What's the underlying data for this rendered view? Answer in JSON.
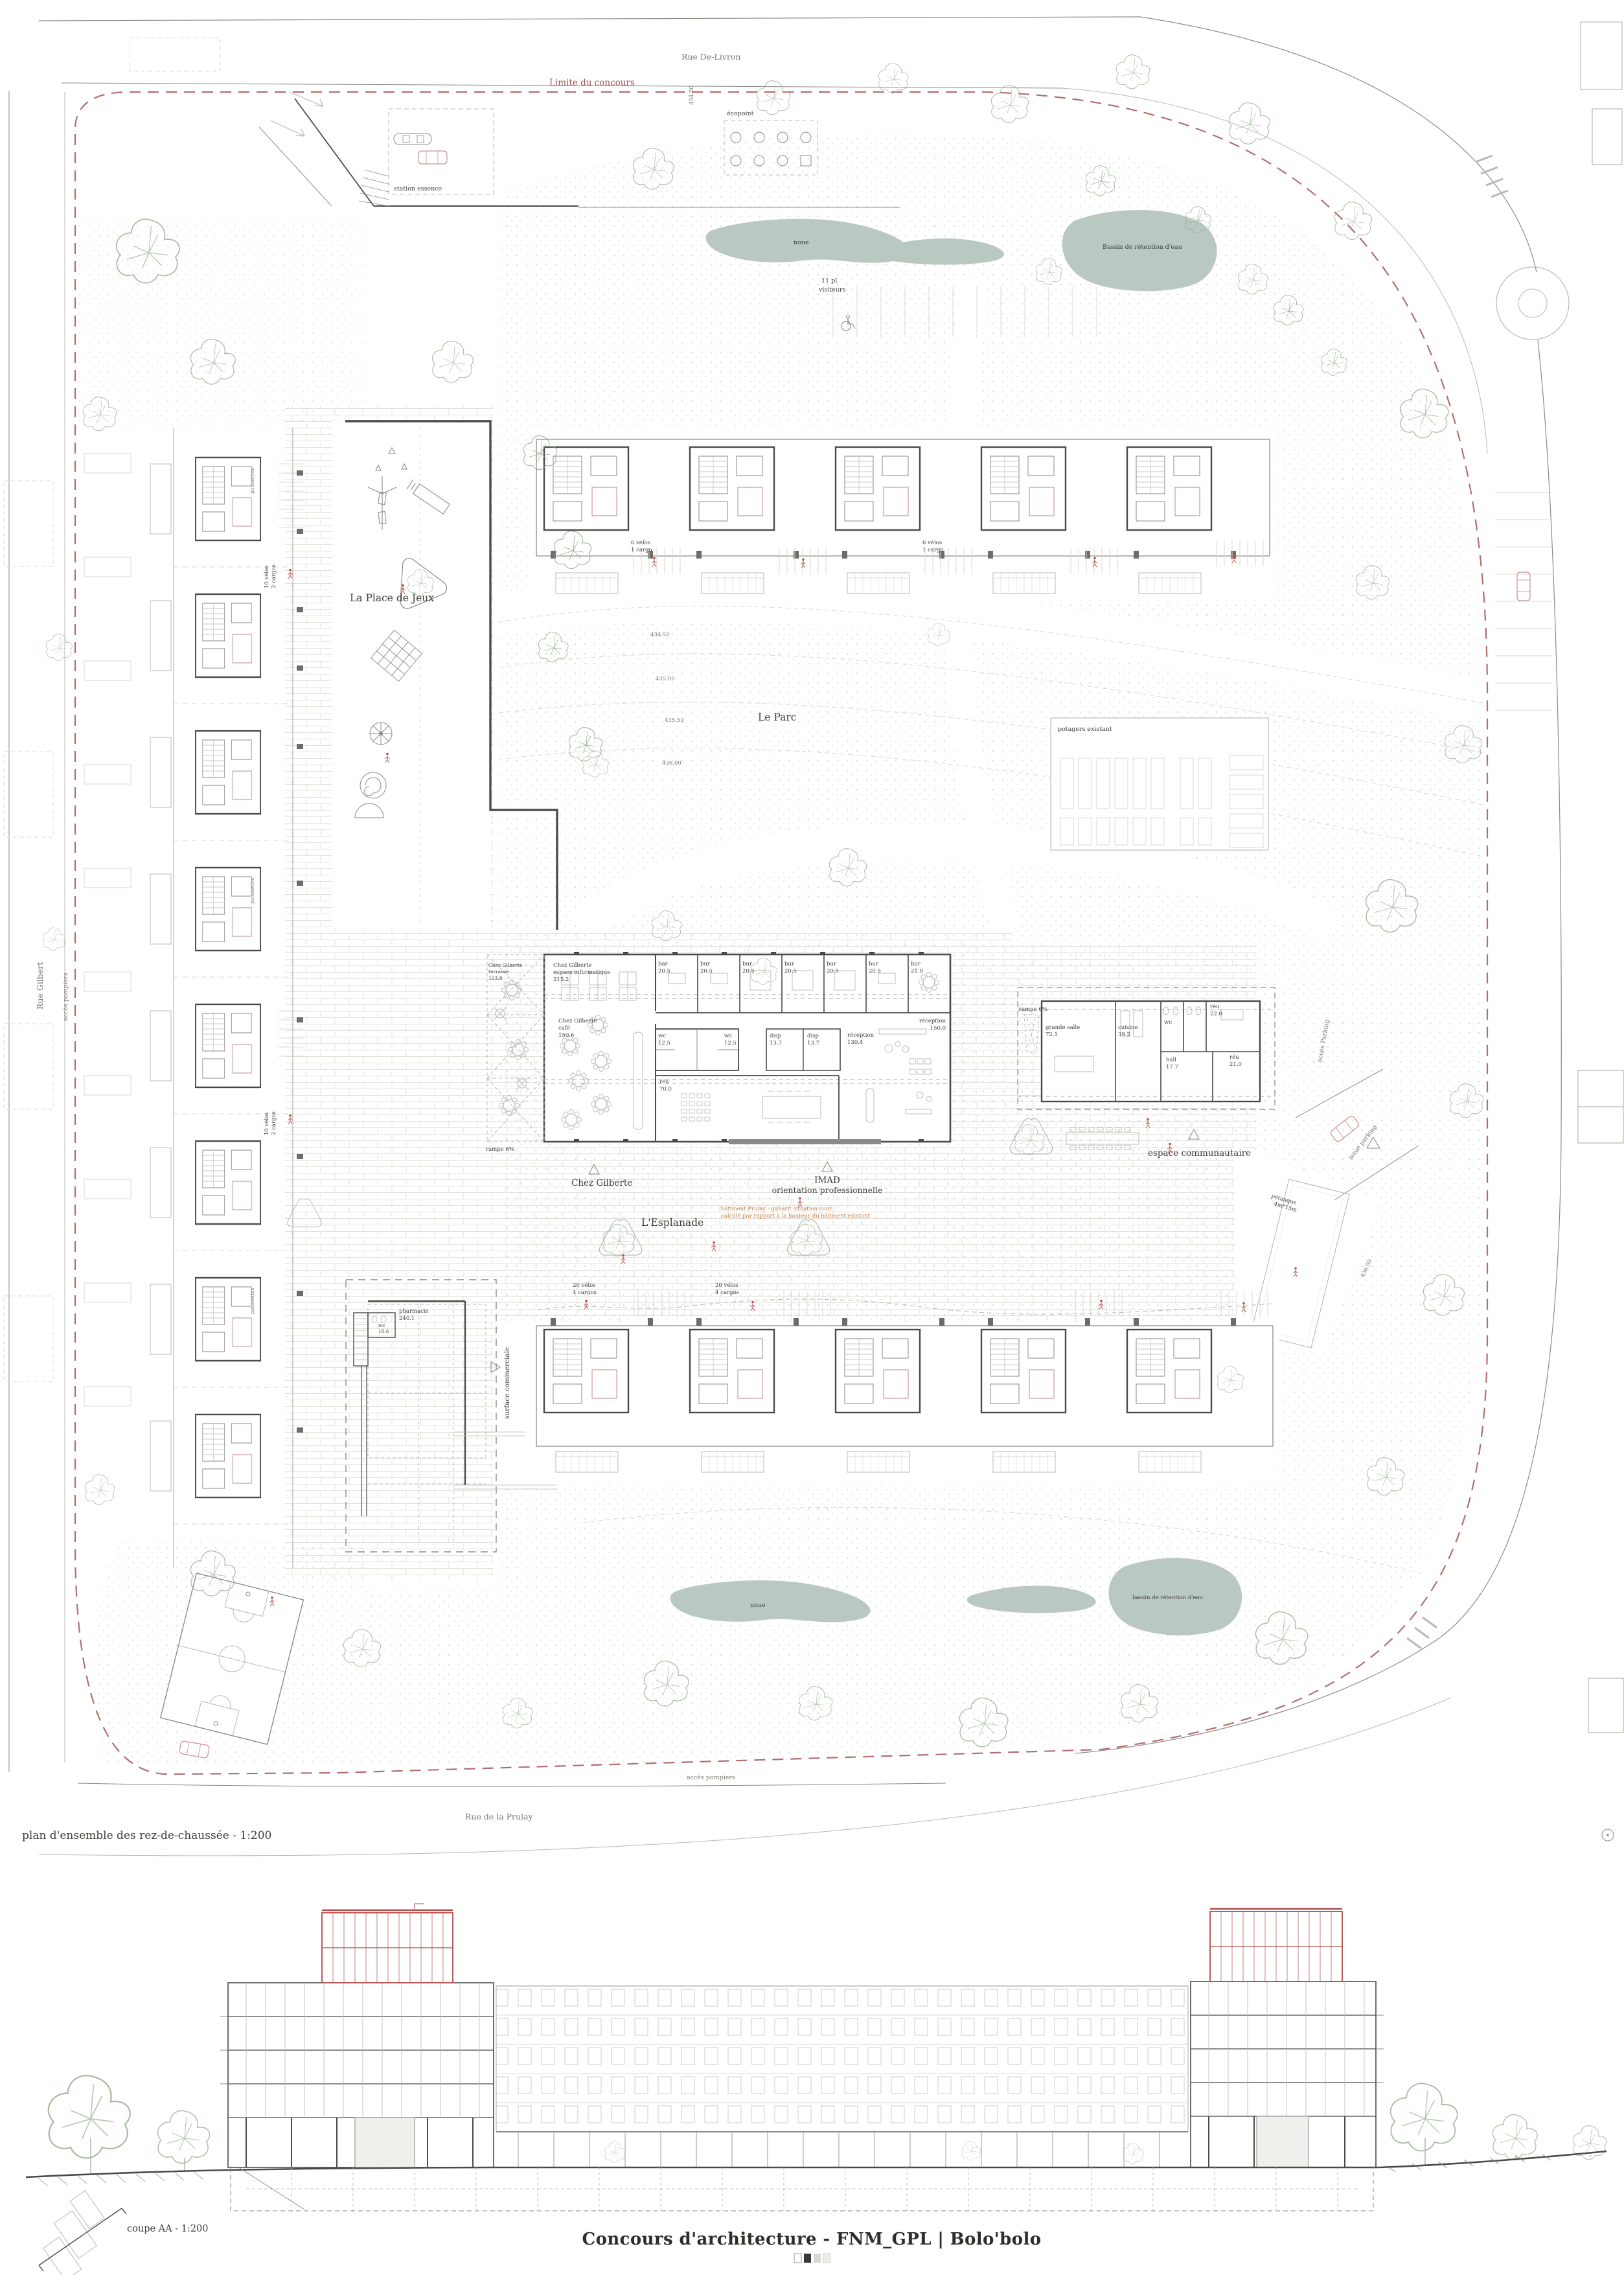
{
  "sheet": {
    "title": "Concours d'architecture - FNM_GPL | Bolo'bolo",
    "plan_caption": "plan d'ensemble des rez-de-chaussée - 1:200",
    "section_caption": "coupe AA - 1:200"
  },
  "streets": {
    "top": "Rue De-Livron",
    "left": "Rue Gilbert",
    "bottom": "Rue de la Prulay"
  },
  "boundary_label": "Limite du concours",
  "places": {
    "playground": "La Place de Jeux",
    "park": "Le Parc",
    "esplanade": "L'Esplanade",
    "gardens": "potagers existant",
    "ecopoint": "écopoint",
    "gas_station": "station essence",
    "petanque_l1": "pétanque",
    "petanque_l2": "4m*15m",
    "visitors_l1": "11 pl",
    "visitors_l2": "visiteurs",
    "access_parking": "accès Parking",
    "issue_parking": "issue parking",
    "fire_access": "accès pompiers",
    "ramp": "rampe 6%"
  },
  "water": {
    "noue": "noue",
    "basin_top": "Bassin de rétention d'eau",
    "basin_bottom": "bassin de rétention d'eau"
  },
  "contours": {
    "a": "434.50",
    "b": "435.00",
    "c": "435.50",
    "d": "436.00"
  },
  "chez_gilberte": {
    "label": "Chez Gilberte",
    "terrasse": [
      "Chez Gilberte",
      "terrasse",
      "123.8"
    ],
    "informatique": [
      "Chez Gilberte",
      "espace informatique",
      "215.2"
    ],
    "cafe": [
      "Chez Gilberte",
      "café",
      "150.6"
    ],
    "bar_n": "bar",
    "bar_a": "20.5"
  },
  "imad": {
    "label": "IMAD",
    "sublabel": "orientation professionnelle",
    "offices": [
      {
        "n": "bur",
        "a": "20.5"
      },
      {
        "n": "bur",
        "a": "20.5"
      },
      {
        "n": "bur",
        "a": "20.5"
      },
      {
        "n": "bur",
        "a": "20.5"
      },
      {
        "n": "bur",
        "a": "20.5"
      },
      {
        "n": "bur",
        "a": "21.0"
      }
    ],
    "wc_n": "wc",
    "wc_a": "12.5",
    "disp_n": "disp",
    "disp_a": "13.7",
    "reu_n": "réu",
    "reu_a": "70.0",
    "rec1_n": "réception",
    "rec1_a": "130.4",
    "rec2_n": "réception",
    "rec2_a": "150.0"
  },
  "communautaire": {
    "label": "espace communautaire",
    "salle_n": "grande salle",
    "salle_a": "72.1",
    "cuisine_n": "cuisine",
    "cuisine_a": "39.2",
    "wc": "wc",
    "reu1_n": "réu",
    "reu1_a": "22.0",
    "hall_n": "hall",
    "hall_a": "17.7",
    "reu2_n": "réu",
    "reu2_a": "21.0"
  },
  "commercial": {
    "label": "surface commerciale",
    "pharmacie_n": "pharmacie",
    "pharmacie_a": "240.1",
    "wc_n": "wc",
    "wc_a": "10.6"
  },
  "note_orange": {
    "l1": "bâtiment Prulay - gabarit situation cour",
    "l2": "calculé par rapport à la hauteur du bâtiment existant"
  },
  "bikes": {
    "poussettes": "poussettes",
    "top_l1": "6 vélos",
    "top_l2": "1 cargo",
    "left_l1": "10 vélos",
    "left_l2": "2 cargos",
    "bottom_l1": "20 vélos",
    "bottom_l2": "4 cargos"
  },
  "colors": {
    "limite": "#a65353",
    "water": "#b9c8c0",
    "tree": "#a5bca0",
    "accent": "#b24d4d",
    "orange": "#bf7a3f",
    "ink": "#4b4a46",
    "section_red": "#b04a4a"
  }
}
